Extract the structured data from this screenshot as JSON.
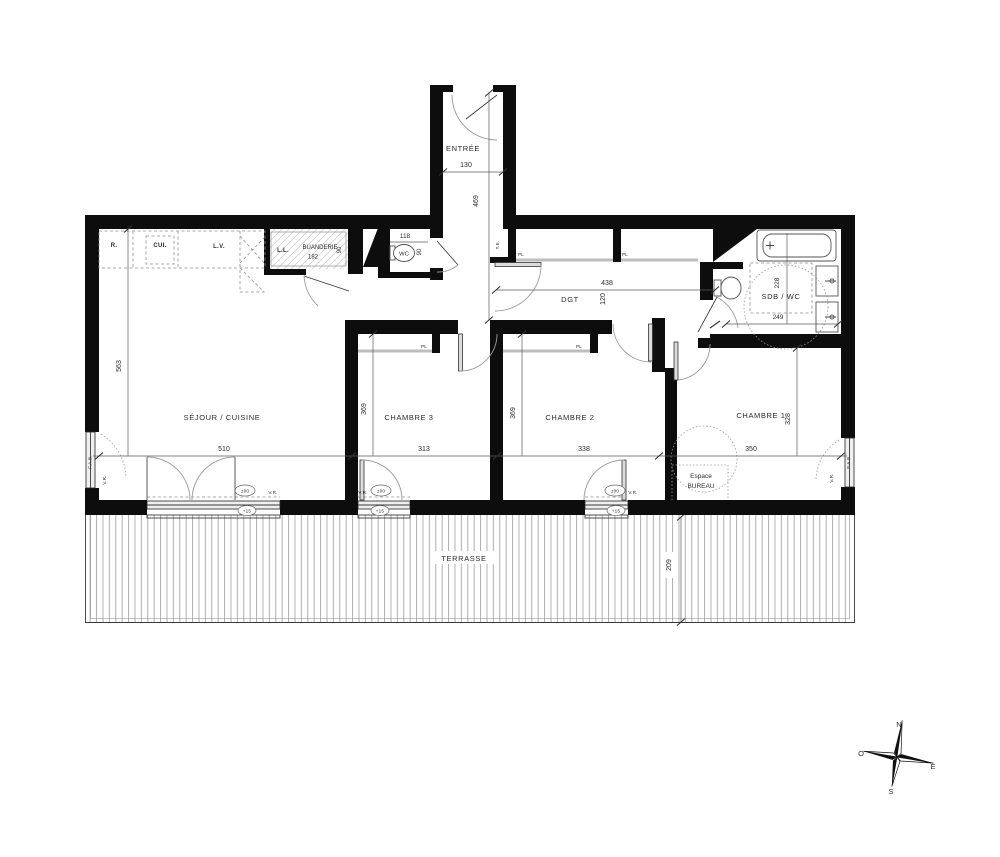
{
  "plan": {
    "entree": {
      "name": "ENTRÉE",
      "w": "130",
      "h": "469"
    },
    "wc": {
      "name": "WC",
      "w": "118",
      "door": "90"
    },
    "buanderie": {
      "name": "BUANDERIE",
      "area": "182",
      "door": "90"
    },
    "kitchen": {
      "r": "R.",
      "cui": "CUI.",
      "lv": "L.V.",
      "ll": "L.L."
    },
    "te": "T.E.",
    "pl": "PL",
    "dgt": {
      "name": "DGT",
      "w": "438",
      "h": "120"
    },
    "sdb": {
      "name": "SDB / WC",
      "h": "228",
      "w": "249"
    },
    "sejour": {
      "name": "SÉJOUR / CUISINE",
      "h": "563",
      "w": "510"
    },
    "ch3": {
      "name": "CHAMBRE 3",
      "h": "369",
      "w": "313"
    },
    "ch2": {
      "name": "CHAMBRE 2",
      "h": "369",
      "w": "338"
    },
    "ch1": {
      "name": "CHAMBRE 1",
      "h": "328",
      "w": "350"
    },
    "bureau": {
      "l1": "Espace",
      "l2": "BUREAU"
    },
    "terrasse": {
      "name": "TERRASSE",
      "d": "209"
    },
    "win": {
      "fab": "F.A.B.",
      "vr": "V.R.",
      "pf": "P.F.",
      "lvl0": "±00",
      "lvl15": "+15"
    },
    "compass": {
      "n": "N",
      "e": "E",
      "s": "S",
      "o": "O"
    }
  }
}
